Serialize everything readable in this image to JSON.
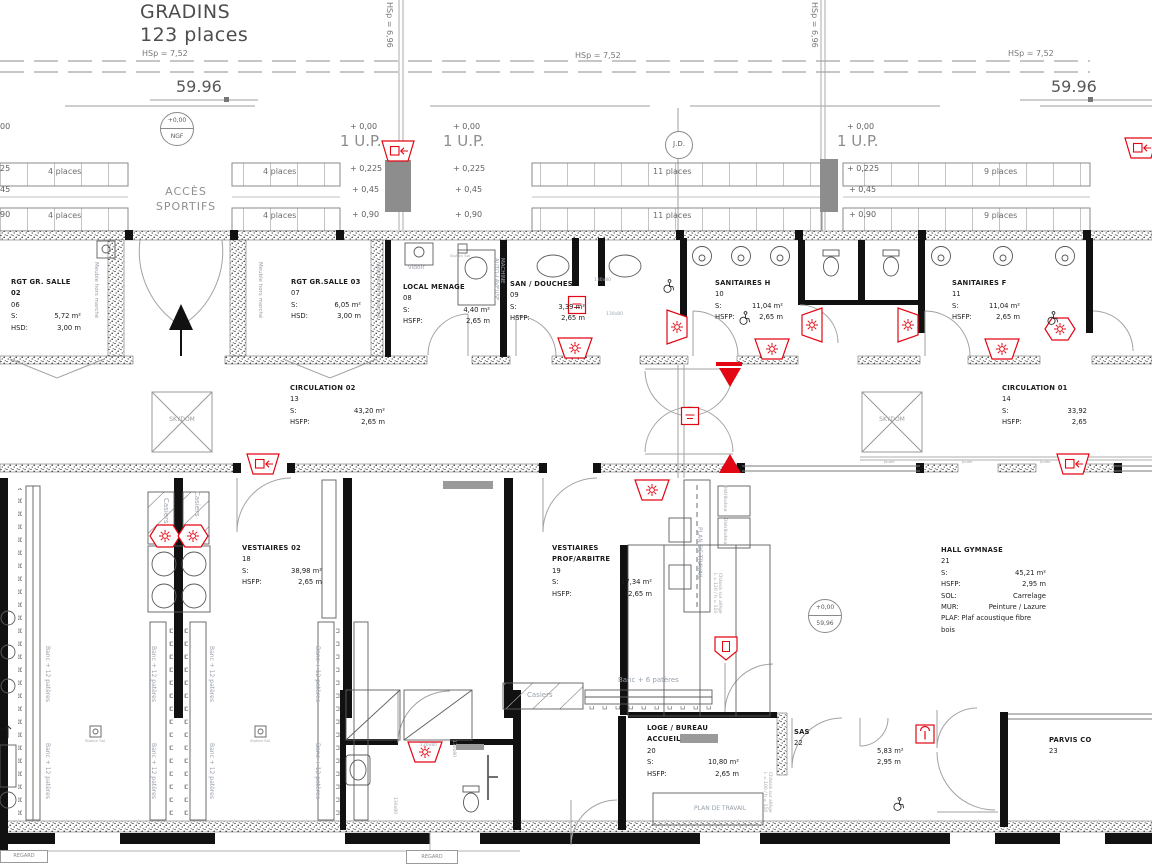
{
  "title": {
    "name": "GRADINS",
    "capacity": "123 places"
  },
  "labels": {
    "hsp_roof": "HSp = 7,52",
    "hsp_col": "HSp = 6,96",
    "elev": "59.96",
    "ngf_top": "+0,00",
    "ngf_bottom": "NGF",
    "lvl_top": "+0,00",
    "lvl_bottom": "59,96",
    "up": "1 U.P.",
    "lv000": "+ 0,00",
    "lv0225": "+ 0,225",
    "lv045": "+ 0,45",
    "lv090": "+ 0,90",
    "edge00": "00",
    "edge25": "25",
    "edge45": "45",
    "edge90": "90",
    "jd": "J.D.",
    "acces1": "ACCÈS",
    "acces2": "SPORTIFS",
    "p4": "4 places",
    "p11": "11 places",
    "p9": "9 places",
    "skydom": "SKYDOM",
    "meuble": "Meuble hors marché",
    "vidoir": "vidoir",
    "machine1": "MACHINE",
    "machine2": "AUTO-LAVEUSE",
    "dim": "130x80",
    "casiers": "Casiers",
    "banc12": "Banc + 12 patères",
    "banc6": "Banc + 6 patères",
    "plan_travail": "PLAN DE TRAVAIL",
    "distributeur": "Distributeur",
    "chassis_a": "Châssis sur allège",
    "chassis120": "L = 120 / h = 110",
    "chassis100": "L = 100 / h = 110",
    "siphon": "Siphon Sol",
    "jouee": "Jouée",
    "regard": "REGARD"
  },
  "rooms": {
    "rgt02": {
      "name": "RGT GR. SALLE 02",
      "num": "06",
      "sl": "S:",
      "sv": "5,72 m²",
      "hl": "HSD:",
      "hv": "3,00 m"
    },
    "rgt03": {
      "name": "RGT GR.SALLE 03",
      "num": "07",
      "sl": "S:",
      "sv": "6,05 m²",
      "hl": "HSD:",
      "hv": "3,00 m"
    },
    "menage": {
      "name": "LOCAL MENAGE",
      "num": "08",
      "sl": "S:",
      "sv": "4,40 m²",
      "hl": "HSFP:",
      "hv": "2,65 m"
    },
    "douches": {
      "name": "SAN / DOUCHES",
      "num": "09",
      "sl": "S:",
      "sv": "3,39 m²",
      "hl": "HSFP:",
      "hv": "2,65 m"
    },
    "sanh": {
      "name": "SANITAIRES H",
      "num": "10",
      "sl": "S:",
      "sv": "11,04 m²",
      "hl": "HSFP:",
      "hv": "2,65 m"
    },
    "sanf": {
      "name": "SANITAIRES F",
      "num": "11",
      "sl": "S:",
      "sv": "11,04 m²",
      "hl": "HSFP:",
      "hv": "2,65 m"
    },
    "circ2": {
      "name": "CIRCULATION 02",
      "num": "13",
      "sl": "S:",
      "sv": "43,20 m²",
      "hl": "HSFP:",
      "hv": "2,65 m"
    },
    "circ1": {
      "name": "CIRCULATION 01",
      "num": "14",
      "sl": "S:",
      "sv": "33,92",
      "hl": "HSFP:",
      "hv": "2,65"
    },
    "vest2": {
      "name": "VESTIAIRES 02",
      "num": "18",
      "sl": "S:",
      "sv": "38,98 m²",
      "hl": "HSFP:",
      "hv": "2,65 m"
    },
    "vestprof": {
      "name": "VESTIAIRES PROF/ARBITRE",
      "num": "19",
      "sl": "S:",
      "sv": "17,34 m²",
      "hl": "HSFP:",
      "hv": "2,65 m"
    },
    "hall": {
      "name": "HALL GYMNASE",
      "num": "21",
      "sl": "S:",
      "sv": "45,21 m²",
      "hl": "HSFP:",
      "hv": "2,95 m",
      "soll": "SOL:",
      "solv": "Carrelage",
      "murl": "MUR:",
      "murv": "Peinture / Lazure",
      "plaf": "PLAF: Plaf acoustique fibre bois"
    },
    "loge": {
      "name": "LOGE / BUREAU ACCUEIL",
      "num": "20",
      "sl": "S:",
      "sv": "10,80 m²",
      "hl": "HSFP:",
      "hv": "2,65 m"
    },
    "sas": {
      "name": "SAS",
      "num": "22",
      "sv": "5,83 m²",
      "hv": "2,95 m"
    },
    "parvis": {
      "name": "PARVIS CO",
      "num": "23"
    }
  },
  "colors": {
    "safety_red": "#e30613",
    "stair_gray": "#8d8d8d",
    "line_gray": "#8a8a8a",
    "wall_black": "#111111"
  }
}
